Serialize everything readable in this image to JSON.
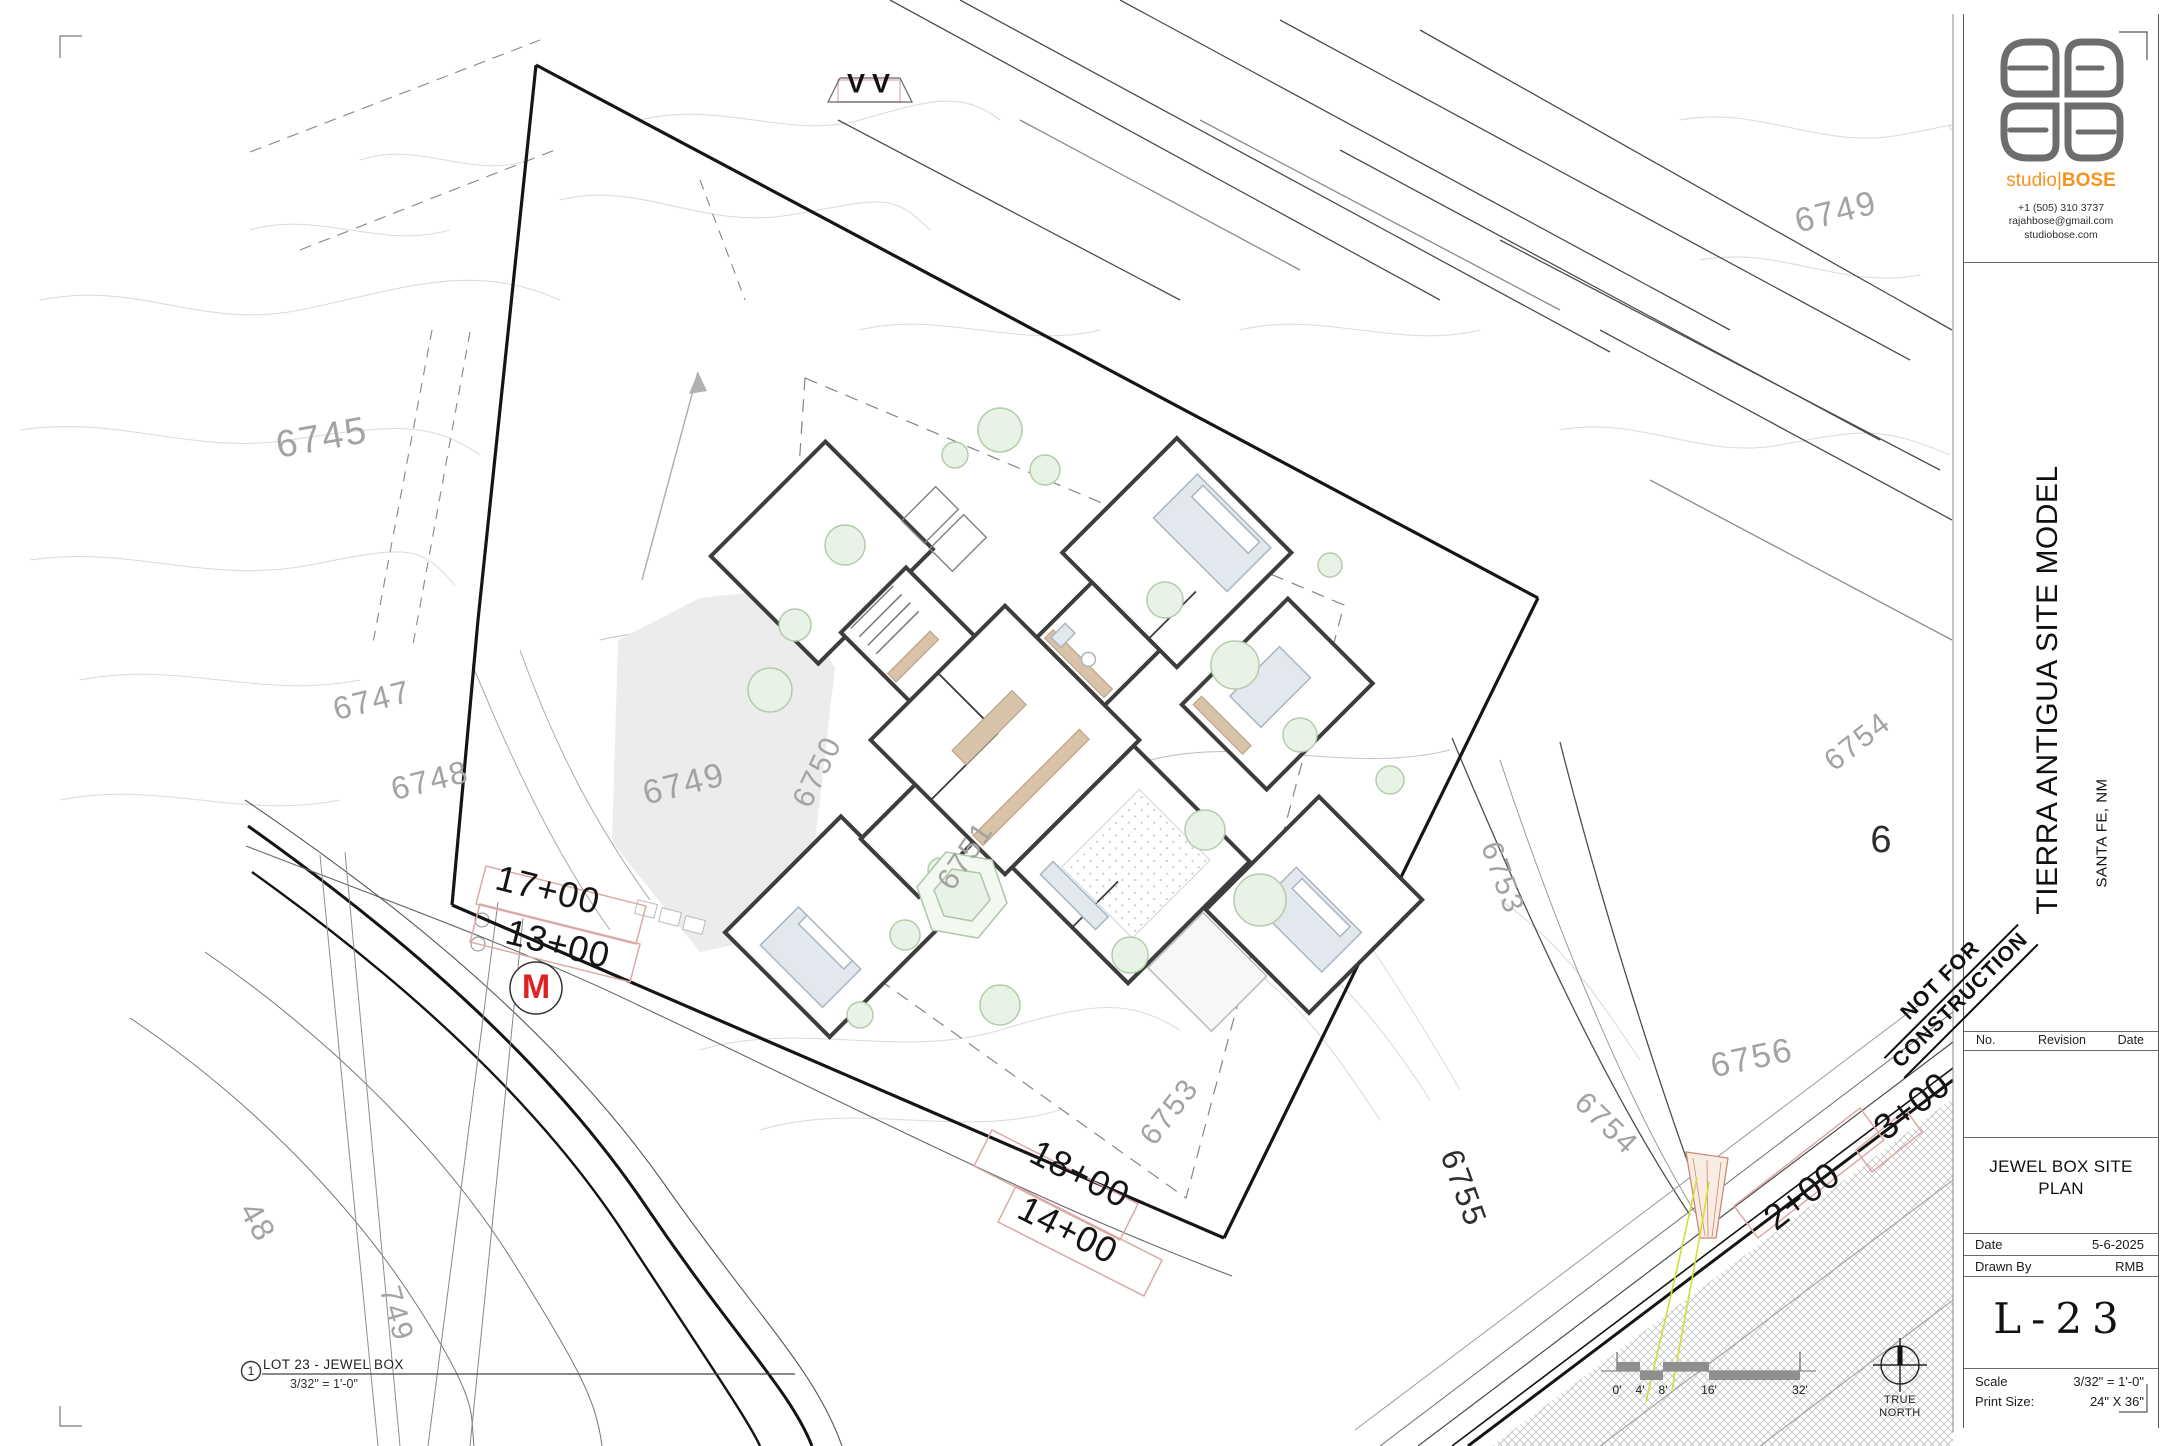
{
  "colors": {
    "brand_orange": "#F6921E",
    "marker_red": "#DD2222",
    "contour_gray": "#A3A3A3",
    "station_box_pink": "#DCA9A5",
    "vegetation_green": "#BFD8B8"
  },
  "title_block": {
    "brand_pre": "studio|",
    "brand_name": "BOSE",
    "phone": "+1 (505) 310 3737",
    "email": "rajahbose@gmail.com",
    "website": "studiobose.com",
    "project_title": "TIERRA ANTIGUA SITE MODEL",
    "project_location": "SANTA FE, NM",
    "stamp_line1": "NOT FOR",
    "stamp_line2": "CONSTRUCTION",
    "revision_headers": [
      "No.",
      "Revision",
      "Date"
    ],
    "sheet_name_line1": "JEWEL BOX SITE",
    "sheet_name_line2": "PLAN",
    "date_label": "Date",
    "date_value": "5-6-2025",
    "drawn_by_label": "Drawn By",
    "drawn_by_value": "RMB",
    "sheet_number": "L-23",
    "scale_label": "Scale",
    "scale_value": "3/32\" = 1'-0\"",
    "print_size_label": "Print Size:",
    "print_size_value": "24\" X 36\""
  },
  "drawing": {
    "view_number": "1",
    "view_title": "LOT 23 - JEWEL BOX",
    "view_scale": "3/32\" = 1'-0\"",
    "section_marker": "VV",
    "utility_marker": "M",
    "north_label_line1": "TRUE",
    "north_label_line2": "NORTH",
    "scale_bar_labels": [
      "0'",
      "4'",
      "8'",
      "16'",
      "32'"
    ],
    "contour_labels": [
      {
        "text": "6745",
        "x": 322,
        "y": 438,
        "rot": -10,
        "size": 38
      },
      {
        "text": "6747",
        "x": 372,
        "y": 700,
        "rot": -14,
        "size": 32
      },
      {
        "text": "6748",
        "x": 430,
        "y": 780,
        "rot": -14,
        "size": 32
      },
      {
        "text": "6749",
        "x": 684,
        "y": 784,
        "rot": -14,
        "size": 34
      },
      {
        "text": "6749",
        "x": 1836,
        "y": 212,
        "rot": -14,
        "size": 34
      },
      {
        "text": "6750",
        "x": 818,
        "y": 772,
        "rot": -64,
        "size": 30
      },
      {
        "text": "6751",
        "x": 966,
        "y": 856,
        "rot": -56,
        "size": 30
      },
      {
        "text": "6753",
        "x": 1170,
        "y": 1112,
        "rot": -52,
        "size": 30
      },
      {
        "text": "6753",
        "x": 1502,
        "y": 878,
        "rot": 70,
        "size": 30
      },
      {
        "text": "6754",
        "x": 1606,
        "y": 1124,
        "rot": 44,
        "size": 30
      },
      {
        "text": "6754",
        "x": 1858,
        "y": 742,
        "rot": -38,
        "size": 30
      },
      {
        "text": "6755",
        "x": 1464,
        "y": 1188,
        "rot": 70,
        "size": 32,
        "dark": true
      },
      {
        "text": "6756",
        "x": 1752,
        "y": 1058,
        "rot": -12,
        "size": 34
      },
      {
        "text": "6",
        "x": 1882,
        "y": 840,
        "rot": 0,
        "size": 38,
        "dark": true
      },
      {
        "text": "48",
        "x": 258,
        "y": 1222,
        "rot": 60,
        "size": 32
      },
      {
        "text": "749",
        "x": 396,
        "y": 1314,
        "rot": 74,
        "size": 30
      }
    ],
    "station_labels": [
      {
        "text": "17+00",
        "x": 548,
        "y": 890,
        "rot": 14
      },
      {
        "text": "13+00",
        "x": 558,
        "y": 944,
        "rot": 14
      },
      {
        "text": "18+00",
        "x": 1080,
        "y": 1174,
        "rot": 27
      },
      {
        "text": "14+00",
        "x": 1068,
        "y": 1230,
        "rot": 27
      },
      {
        "text": "2+00",
        "x": 1802,
        "y": 1196,
        "rot": -38
      },
      {
        "text": "3+00",
        "x": 1912,
        "y": 1106,
        "rot": -38
      }
    ]
  }
}
